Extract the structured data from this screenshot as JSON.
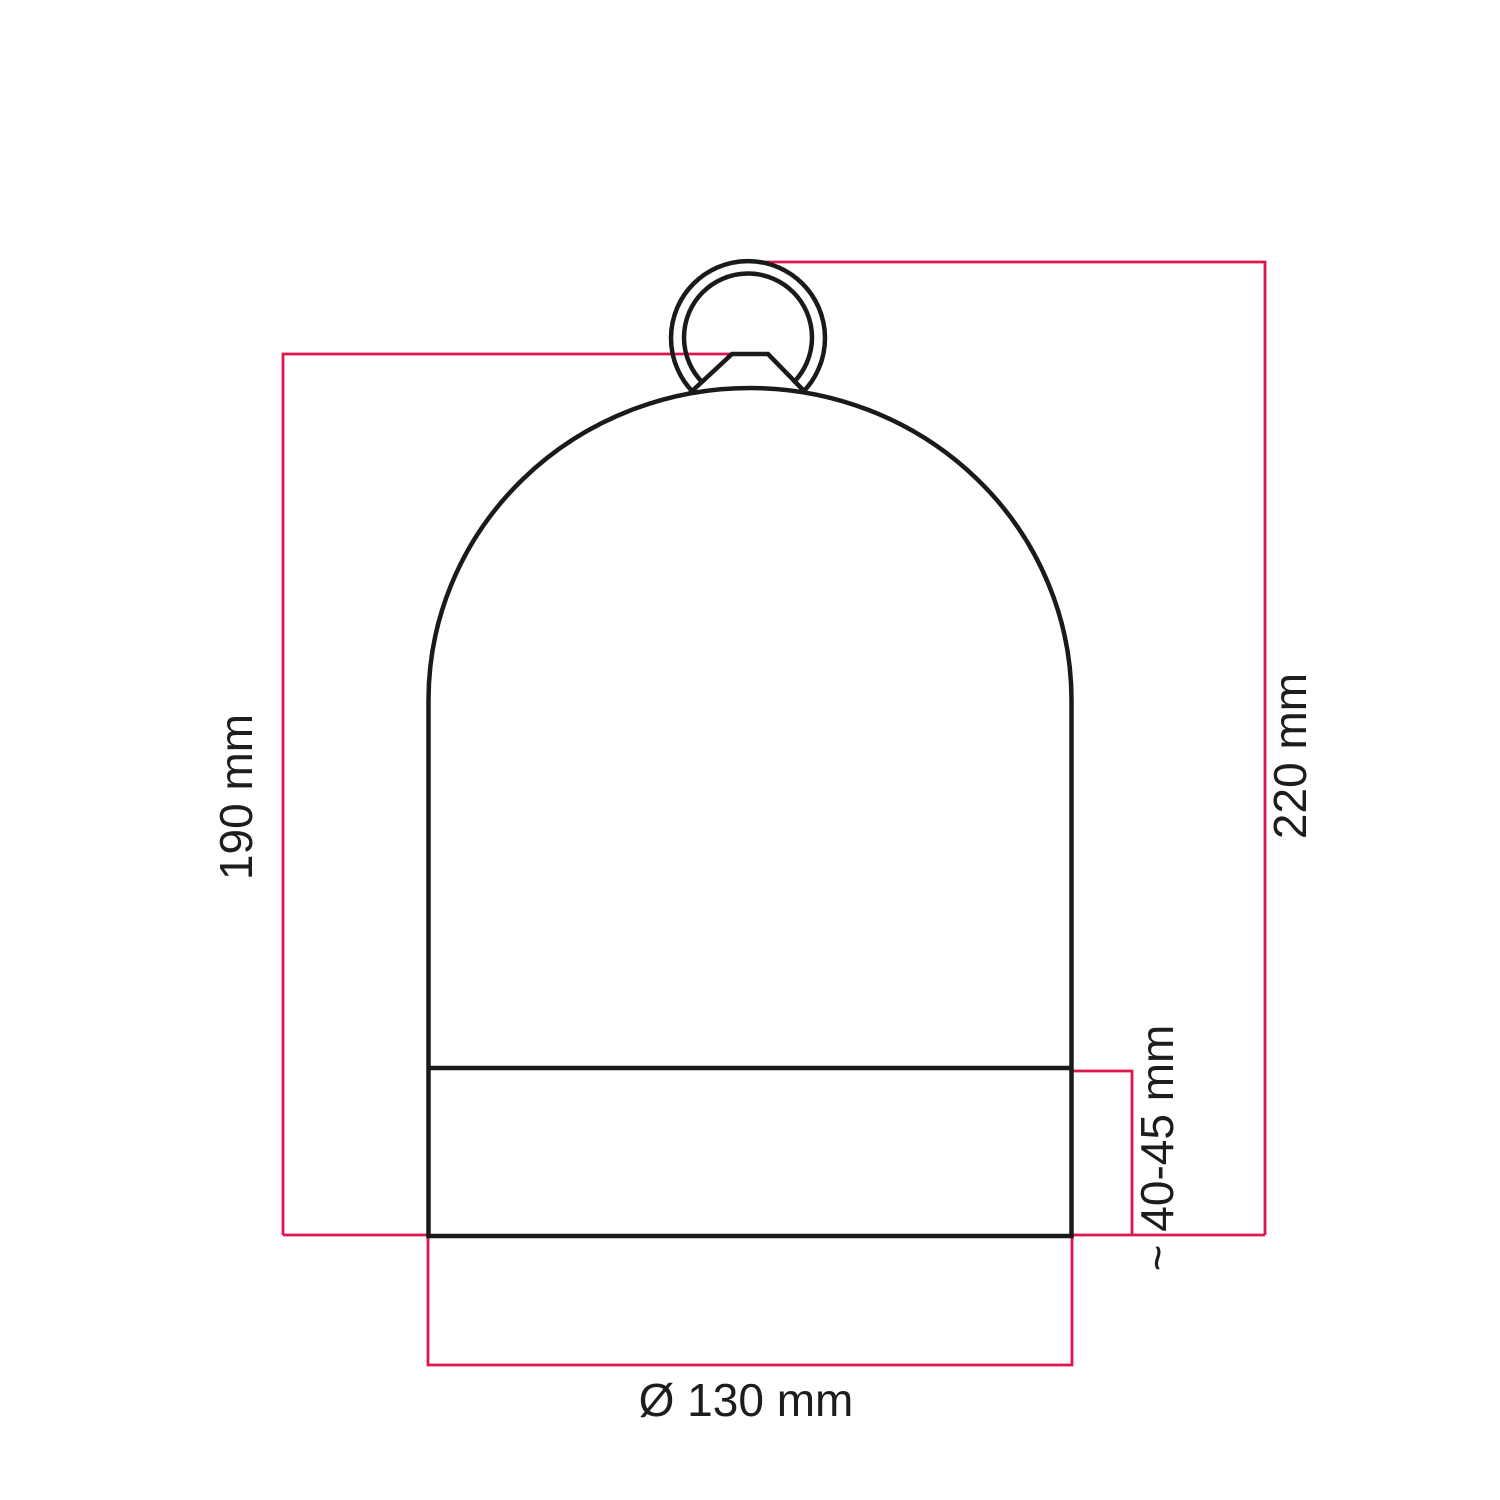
{
  "diagram": {
    "labels": {
      "shade_height": "190 mm",
      "total_height": "220 mm",
      "base_height": "~ 40-45 mm",
      "diameter": "Ø 130 mm"
    },
    "colors": {
      "dimension_line": "#e0154e",
      "drawing_line": "#1a1a1a",
      "text": "#1d1d1b",
      "background": "#ffffff"
    }
  }
}
